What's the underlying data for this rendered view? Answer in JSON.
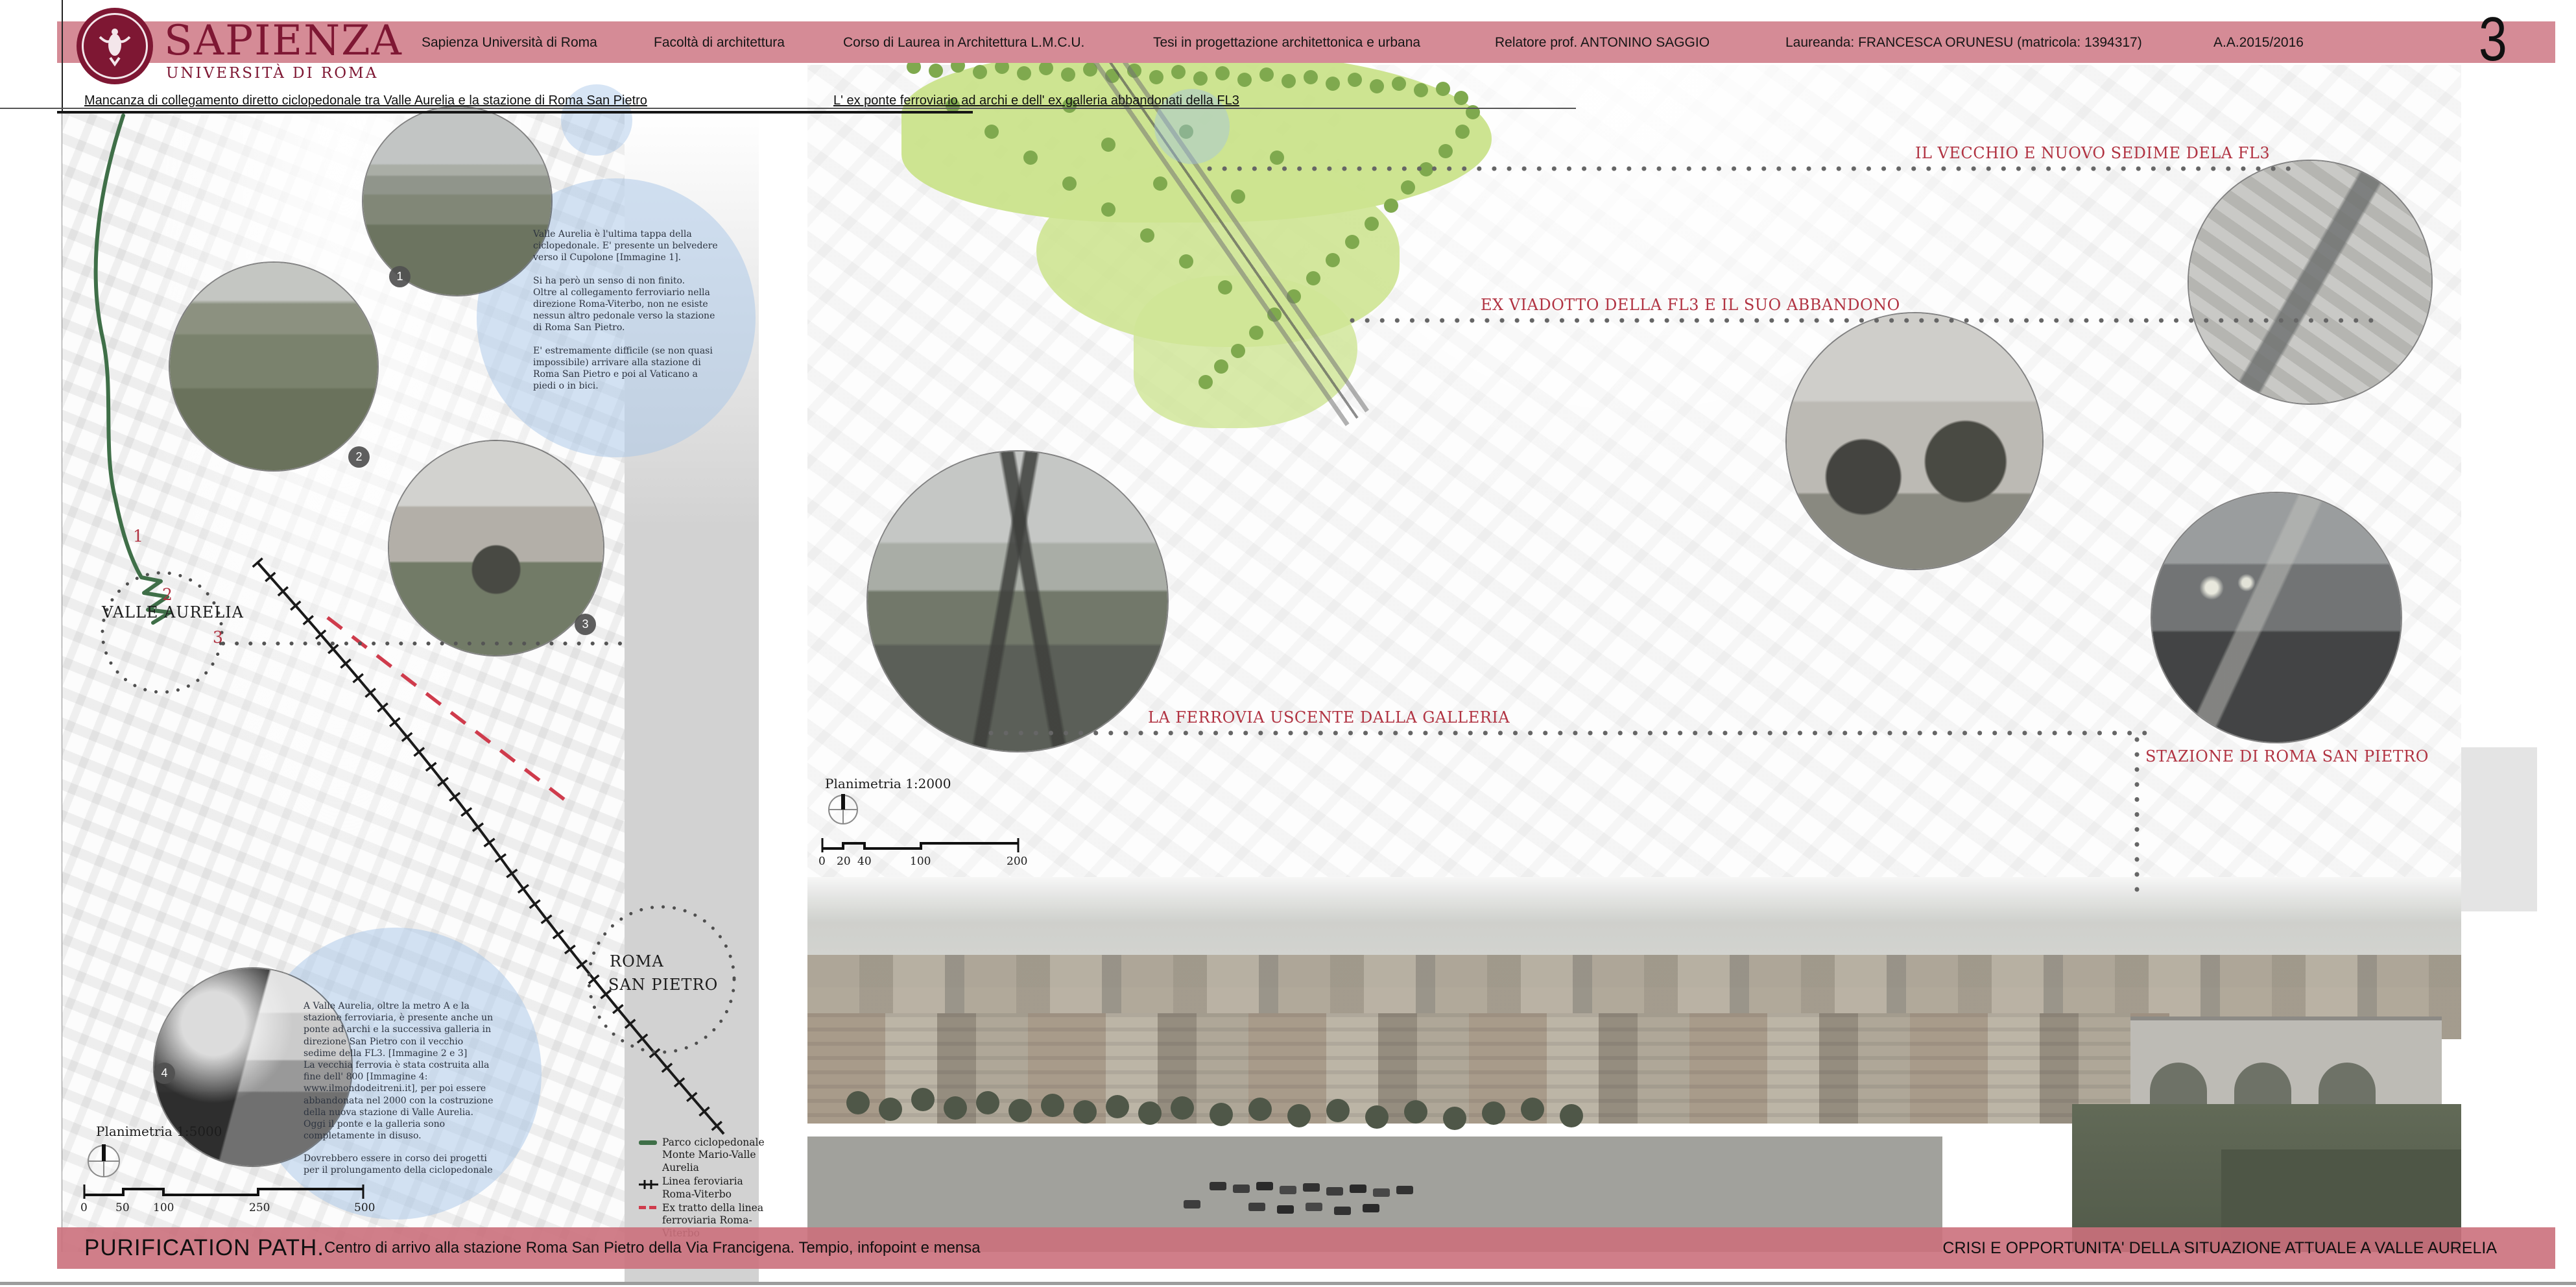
{
  "brand": {
    "wordmark": "SAPIENZA",
    "subtitle": "UNIVERSITÀ DI ROMA"
  },
  "header": {
    "items": [
      "Sapienza Università di Roma",
      "Facoltà di architettura",
      "Corso di Laurea in Architettura L.M.C.U.",
      "Tesi in progettazione architettonica e urbana",
      "Relatore prof. ANTONINO SAGGIO",
      "Laureanda: FRANCESCA ORUNESU (matricola: 1394317)",
      "A.A.2015/2016"
    ],
    "page_number": "3"
  },
  "captions": {
    "left": "Mancanza di collegamento diretto ciclopedonale tra Valle Aurelia e la stazione di Roma San Pietro",
    "right": "L' ex ponte ferroviario ad archi e dell' ex galleria abbandonati della FL3"
  },
  "left_map": {
    "plan_label": "Planimetria 1:5000",
    "scale_ticks": [
      "0",
      "50",
      "100",
      "250",
      "500"
    ],
    "place_labels": {
      "valle_aurelia": "VALLE AURELIA",
      "roma": "ROMA",
      "san_pietro": "SAN PIETRO"
    },
    "route_markers": [
      "1",
      "2",
      "3"
    ],
    "photo_badges": [
      "1",
      "2",
      "3",
      "4"
    ],
    "note_1": {
      "p1": "Valle Aurelia è l'ultima tappa della ciclopedonale. E' presente un belvedere verso il Cupolone [Immagine 1].",
      "p2": "Si ha però un senso di non finito.",
      "p3": "Oltre al collegamento ferroviario nella direzione Roma-Viterbo, non ne esiste nessun altro pedonale verso la stazione di Roma San Pietro.",
      "p4": "E' estremamente difficile (se non quasi impossibile) arrivare alla stazione di Roma San Pietro e poi al Vaticano a piedi o in bici."
    },
    "note_2": {
      "p1": "A Valle Aurelia, oltre la metro A e la stazione ferroviaria, è presente anche un ponte ad archi e la successiva galleria in direzione San Pietro con il vecchio sedime della FL3. [Immagine 2 e 3]",
      "p2": "La vecchia ferrovia è stata costruita alla fine dell' 800 [Immagine 4: www.ilmondodeitreni.it], per poi essere abbandonata nel 2000 con la costruzione della nuova stazione di Valle Aurelia.",
      "p3": "Oggi il ponte e la galleria sono  completamente in disuso.",
      "p4": "Dovrebbero essere in corso dei progetti per il prolungamento della ciclopedonale"
    },
    "legend": {
      "items": [
        {
          "symbol": "green-line",
          "label": "Parco ciclopedonale Monte Mario-Valle Aurelia"
        },
        {
          "symbol": "railway-line",
          "label": "Linea feroviaria Roma-Viterbo"
        },
        {
          "symbol": "red-dash",
          "label": "Ex tratto della linea ferroviaria Roma- Viterbo"
        }
      ]
    }
  },
  "right_map": {
    "plan_label": "Planimetria 1:2000",
    "scale_ticks": [
      "0",
      "20",
      "40",
      "100",
      "200"
    ],
    "annotations": [
      "IL VECCHIO E NUOVO SEDIME DELA FL3",
      "EX VIADOTTO DELLA FL3 E IL SUO ABBANDONO",
      "LA FERROVIA USCENTE DALLA GALLERIA",
      "STAZIONE DI ROMA SAN PIETRO"
    ]
  },
  "footer": {
    "title": "PURIFICATION PATH.",
    "subtitle": " Centro di arrivo alla stazione Roma San Pietro della Via Francigena. Tempio, infopoint e mensa",
    "right": "CRISI E OPPORTUNITA' DELLA SITUAZIONE ATTUALE A VALLE AURELIA"
  },
  "colors": {
    "header_bar": "#d58b96",
    "footer_bar": "#cb707c",
    "accent_red": "#b13342",
    "path_green": "#3f6f48",
    "park_green": "#c9e288",
    "note_blue": "#a8c6e8",
    "brand_maroon": "#7e1733"
  }
}
